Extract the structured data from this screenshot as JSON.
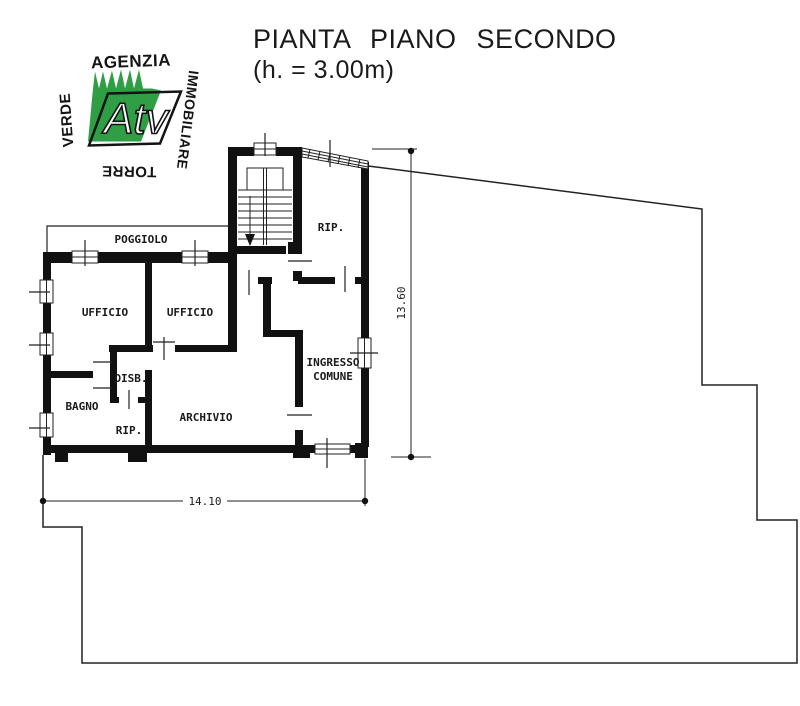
{
  "header": {
    "title": "PIANTA PIANO SECONDO",
    "subtitle": "(h. = 3.00m)"
  },
  "logo": {
    "word_top": "AGENZIA",
    "word_right": "IMMOBILIARE",
    "word_left": "VERDE",
    "word_bottom": "TORRE",
    "monogram": "Atv",
    "green_color": "#2f9e44"
  },
  "plan": {
    "labels": {
      "poggiolo": "POGGIOLO",
      "ufficio_1": "UFFICIO",
      "ufficio_2": "UFFICIO",
      "rip_top": "RIP.",
      "disb": "DISB.",
      "bagno": "BAGNO",
      "rip_small": "RIP.",
      "archivio": "ARCHIVIO",
      "ingresso_line1": "INGRESSO",
      "ingresso_line2": "COMUNE"
    },
    "dimensions": {
      "height_m": "13.60",
      "width_m": "14.10"
    },
    "ink_color": "#1a1a1a"
  }
}
